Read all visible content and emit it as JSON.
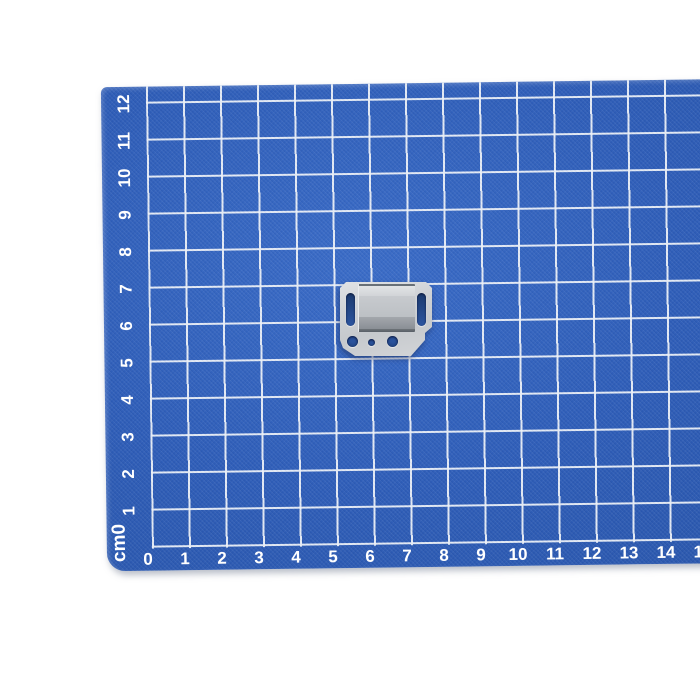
{
  "scene": {
    "background_color": "#ffffff",
    "subject": "metal mounting clip on blue centimeter grid cutting mat"
  },
  "mat": {
    "corner_unit_label": "cm0",
    "x_axis_labels": [
      "0",
      "1",
      "2",
      "3",
      "4",
      "5",
      "6",
      "7",
      "8",
      "9",
      "10",
      "11",
      "12",
      "13",
      "14",
      "15"
    ],
    "y_axis_labels": [
      "1",
      "2",
      "3",
      "4",
      "5",
      "6",
      "7",
      "8",
      "9",
      "10",
      "11",
      "12"
    ],
    "colors": {
      "mat_blue": "#2e5db8",
      "grid_line": "#ecf1f8",
      "label_text": "#ffffff"
    }
  },
  "object": {
    "name": "galvanized metal clip",
    "colors": {
      "metal_light": "#e0e2e5",
      "metal_mid": "#c6c9cd",
      "metal_dark_band": "#8a8f95",
      "hole_blue": "#1d3d74"
    },
    "grid_position": "between 5 and 7.5 cm horizontally, 5 and 7 cm vertically"
  }
}
